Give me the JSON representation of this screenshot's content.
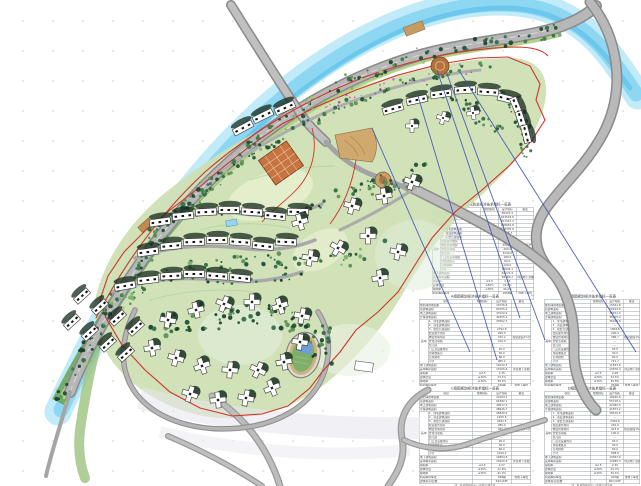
{
  "map": {
    "title": "residential-hillside-master-plan",
    "colors": {
      "river": "#8ed7f2",
      "river_light": "#c2ebfa",
      "road_fill": "#b7b7b7",
      "road_edge": "#8a8a8a",
      "boundary_red": "#d03328",
      "leader_blue": "#3f51b5",
      "lawn_light": "#dcead2",
      "site_green": "#cfe0b4",
      "tree_dark": "#1e4d35",
      "plaza_orange": "#c77440",
      "terrace_tan": "#cfa96e",
      "building_white": "#ffffff",
      "stadium_field": "#7fae68",
      "pool_blue": "#9ad4ec"
    },
    "features": [
      {
        "name": "river-band"
      },
      {
        "name": "main-arterial-road"
      },
      {
        "name": "bridge-road"
      },
      {
        "name": "east-arterial-road"
      },
      {
        "name": "internal-loop-roads"
      },
      {
        "name": "red-boundary-line"
      },
      {
        "name": "slab-buildings"
      },
      {
        "name": "tower-buildings"
      },
      {
        "name": "entry-plaza"
      },
      {
        "name": "terrace-plaza"
      },
      {
        "name": "stadium"
      },
      {
        "name": "leader-lines"
      }
    ]
  },
  "table_template": {
    "columns": [
      "项目",
      "规划指标",
      "设计指标",
      "备注"
    ],
    "section_label": "其中",
    "row_labels": [
      "规划净用地面积",
      "总建筑面积",
      "地上建筑面积",
      "计容建筑面积",
      "1、住宅建筑面积",
      "2、商业建筑面积",
      "3、配套公建面积",
      "社区服务用房",
      "物业管理用房",
      "文化活动站",
      "幼儿园",
      "门卫及设备用房",
      "垃圾收集点",
      "公共厕所",
      "小计",
      "地下建筑面积",
      "其中车库面积",
      "容积率",
      "建筑密度",
      "绿地率",
      "机动车停车位",
      "建筑限高/层数"
    ],
    "plan_values": [
      "",
      "",
      "",
      "",
      "",
      "",
      "",
      "",
      "",
      "",
      "",
      "",
      "",
      "",
      "",
      "",
      "",
      "≤2.5",
      "≤30%",
      "≥30%",
      "",
      ""
    ],
    "remarks": {
      "8": "按总建面1%计",
      "16": "详见地下室图",
      "20": "含地下车位"
    }
  },
  "tables": [
    {
      "title": "建设工程规划总经济技术指标一览表",
      "x": 432,
      "y": 202,
      "w": 102,
      "h": 94,
      "note": "",
      "values": [
        "85323.4",
        "263518.6",
        "201347.2",
        "198652.8",
        "182335.6",
        "6248.7",
        "10068.5",
        "850.0",
        "2015.4",
        "400.0",
        "3240.0",
        "180.0",
        "60.0",
        "120.0",
        "16934.1",
        "62171.4",
        "58360.2",
        "2.33",
        "22.6%",
        "40.2%",
        "1858辆",
        "80m/33F"
      ]
    },
    {
      "title": "A组团规划经济技术指标一览表",
      "x": 419,
      "y": 294,
      "w": 112,
      "h": 92,
      "note": "",
      "values": [
        "19726.5",
        "61055.2",
        "47022.9",
        "46355.1",
        "43562.3",
        "—",
        "2792.8",
        "260.0",
        "470.2",
        "100.0",
        "—",
        "45.0",
        "30.0",
        "60.0",
        "965.2",
        "14032.3",
        "13105.6",
        "2.35",
        "23.1%",
        "38.6%",
        "436辆",
        "54m/18F"
      ]
    },
    {
      "title": "B组团规划经济技术指标一览表",
      "x": 544,
      "y": 294,
      "w": 96,
      "h": 92,
      "note": "",
      "values": [
        "15341.8",
        "50224.6",
        "38671.0",
        "38105.4",
        "36240.8",
        "—",
        "1864.6",
        "200.0",
        "386.7",
        "—",
        "—",
        "45.0",
        "30.0",
        "60.0",
        "721.7",
        "11553.6",
        "10876.4",
        "2.48",
        "24.5%",
        "36.8%",
        "352辆",
        "60m/20F"
      ]
    },
    {
      "title": "C组团规划经济技术指标一览表",
      "x": 419,
      "y": 386,
      "w": 112,
      "h": 94,
      "note": "注：各项面积指标以最终实测为准",
      "values": [
        "21563.2",
        "64382.1",
        "49517.3",
        "48926.7",
        "45830.2",
        "1205.6",
        "2481.5",
        "280.0",
        "495.2",
        "100.0",
        "—",
        "45.0",
        "30.0",
        "60.0",
        "1010.2",
        "14864.8",
        "13920.5",
        "2.27",
        "21.8%",
        "41.3%",
        "468辆",
        "54m/18F"
      ]
    },
    {
      "title": "D组团规划经济技术指标一览表",
      "x": 544,
      "y": 386,
      "w": 96,
      "h": 94,
      "note": "注：各项面积指标以最终实测为准",
      "values": [
        "18240.6",
        "55718.4",
        "42360.5",
        "41873.2",
        "39510.6",
        "—",
        "2362.6",
        "240.0",
        "423.6",
        "100.0",
        "—",
        "45.0",
        "30.0",
        "60.0",
        "898.6",
        "13357.9",
        "12480.3",
        "2.30",
        "22.4%",
        "39.5%",
        "402辆",
        "60m/20F"
      ]
    }
  ]
}
